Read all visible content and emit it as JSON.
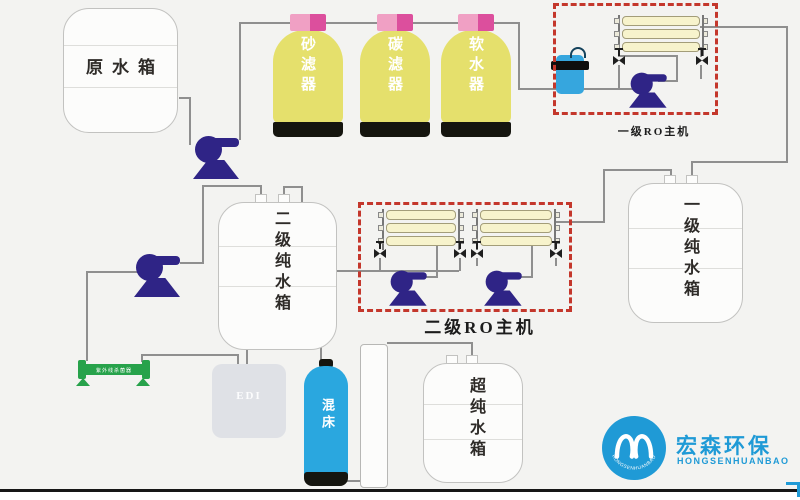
{
  "colors": {
    "bg": "#f3f3f1",
    "pipe": "#8f8f8f",
    "pump": "#2f2486",
    "tankfill": "#fcfcfb",
    "tankline": "#c2c2c0",
    "yellow": "#e5e06c",
    "pink": "#f0a0c4",
    "pinkdark": "#dc4f9d",
    "dark": "#15150f",
    "tube": "#f7f3cc",
    "tubeborder": "#a39d79",
    "red": "#c4372c",
    "green": "#27a24b",
    "edi": "#dfe1e6",
    "bed": "#2aa7df",
    "pf": "#36a6de",
    "logo": "#1f9ad6",
    "text": "#2e2b28"
  },
  "labels": {
    "raw_tank": "原水箱",
    "sand_filter": "砂滤器",
    "carbon_filter": "碳滤器",
    "softener": "软水器",
    "ro1": "一级RO主机",
    "ro2": "二级RO主机",
    "stage1_tank": "一级纯水箱",
    "stage2_tank": "二级纯水箱",
    "ultra_tank": "超纯水箱",
    "mixed_bed": "混床",
    "edi": "EDI",
    "uv": "紫外线杀菌器",
    "logo_cn": "宏森环保",
    "logo_en": "HONGSENHUANBAO"
  }
}
